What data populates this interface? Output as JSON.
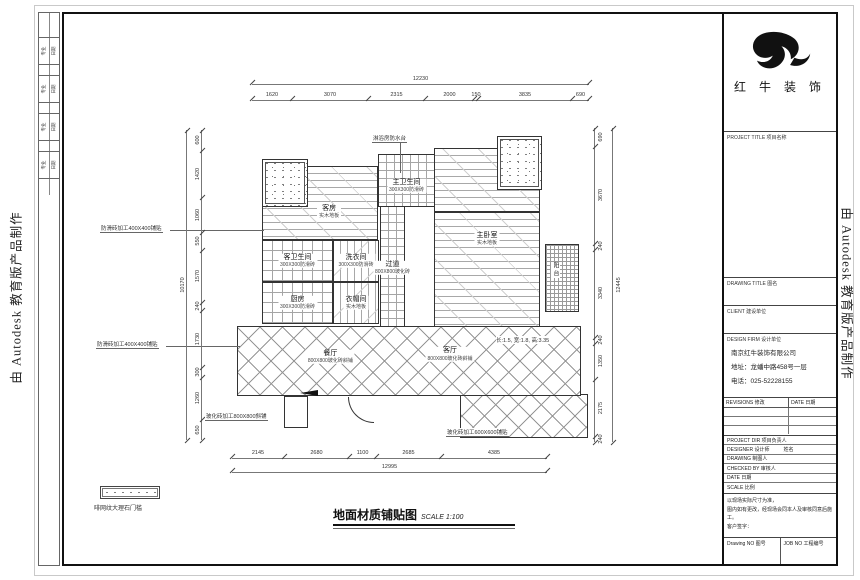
{
  "frame": {
    "autodesk_note": "由 Autodesk 教育版产品制作",
    "sign_cells": [
      [
        "专业",
        "日期"
      ],
      [
        "专业",
        "日期"
      ],
      [
        "专业",
        "日期"
      ],
      [
        "专业",
        "日期"
      ]
    ]
  },
  "brand": {
    "name": "红 牛 装 饰"
  },
  "title_block": {
    "project_title": "PROJECT TITLE  项目名称",
    "drawing_title": "DRAWING TITLE  图名",
    "client": "CLIENT  建设单位",
    "design_firm": "DESIGN FIRM  设计单位",
    "company_name": "南京红牛装饰有限公司",
    "company_address": "地址：龙蟠中路458号一层",
    "company_phone": "电话：025-52228155",
    "revisions": "REVISIONS 修改",
    "date_col": "DATE 日期",
    "project_dir": "PROJECT DIR  项目负责人",
    "designer": "DESIGNER  设计师",
    "designer_name": "姓名",
    "drawing_by": "DRAWING  制图人",
    "checked_by": "CHECKED BY  审核人",
    "date_row": "DATE  日期",
    "scale_row": "SCALE  比例",
    "note_line1": "以现场实际尺寸为准，",
    "note_line2": "图内如有更改，经现场会同本人及审核同意后施工。",
    "note_line3": "客户签字：",
    "drawing_no": "Drawing NO  图号",
    "job_no": "JOB NO  工程编号"
  },
  "plan": {
    "rooms": {
      "guest_room": {
        "name": "客房",
        "mat": "实木地板"
      },
      "master_bath": {
        "name": "主卫生间",
        "mat": "300X300防滑砖"
      },
      "guest_bath": {
        "name": "客卫生间",
        "mat": "300X300防滑砖"
      },
      "laundry": {
        "name": "洗衣间",
        "mat": "300X300防滑砖"
      },
      "corridor": {
        "name": "过道",
        "mat": "800X800玻化砖"
      },
      "master_bed": {
        "name": "主卧室",
        "mat": "实木地板"
      },
      "kitchen": {
        "name": "厨房",
        "mat": "300X300防滑砖"
      },
      "cloak": {
        "name": "衣帽间",
        "mat": "实木地板"
      },
      "dining": {
        "name": "餐厅",
        "mat": "800X800玻化砖斜铺"
      },
      "living": {
        "name": "客厅",
        "mat": "800X800玻化砖斜铺"
      },
      "balcony": {
        "name": "阳台"
      }
    },
    "notes": {
      "top": "淋浴房防水台",
      "left1": "防滑砖加工400X400铺贴",
      "left2": "防滑砖加工400X400铺贴",
      "bottom_left": "玻化砖加工800X800斜铺",
      "bottom_right": "玻化砖加工600X600铺贴",
      "bay": "长:1.5, 宽:1.8, 高:3.35"
    },
    "legend_label": "啡网纹大理石门槛",
    "sheet_title": "地面材质铺贴图",
    "sheet_scale": "SCALE 1:100"
  },
  "dims": {
    "top": {
      "segments": [
        1620,
        3070,
        2315,
        2000,
        150,
        3835,
        690
      ],
      "total": [
        12230
      ]
    },
    "bottom": {
      "segments": [
        2145,
        2680,
        1100,
        2685,
        4385
      ],
      "total": [
        12995
      ]
    },
    "left": {
      "segments": [
        600,
        1420,
        1060,
        550,
        1570,
        240,
        1730,
        300,
        1260,
        650
      ],
      "total": [
        10170
      ]
    },
    "right": {
      "segments": [
        690,
        3670,
        240,
        3340,
        240,
        1350,
        2175,
        240
      ],
      "total": [
        12445
      ]
    }
  }
}
